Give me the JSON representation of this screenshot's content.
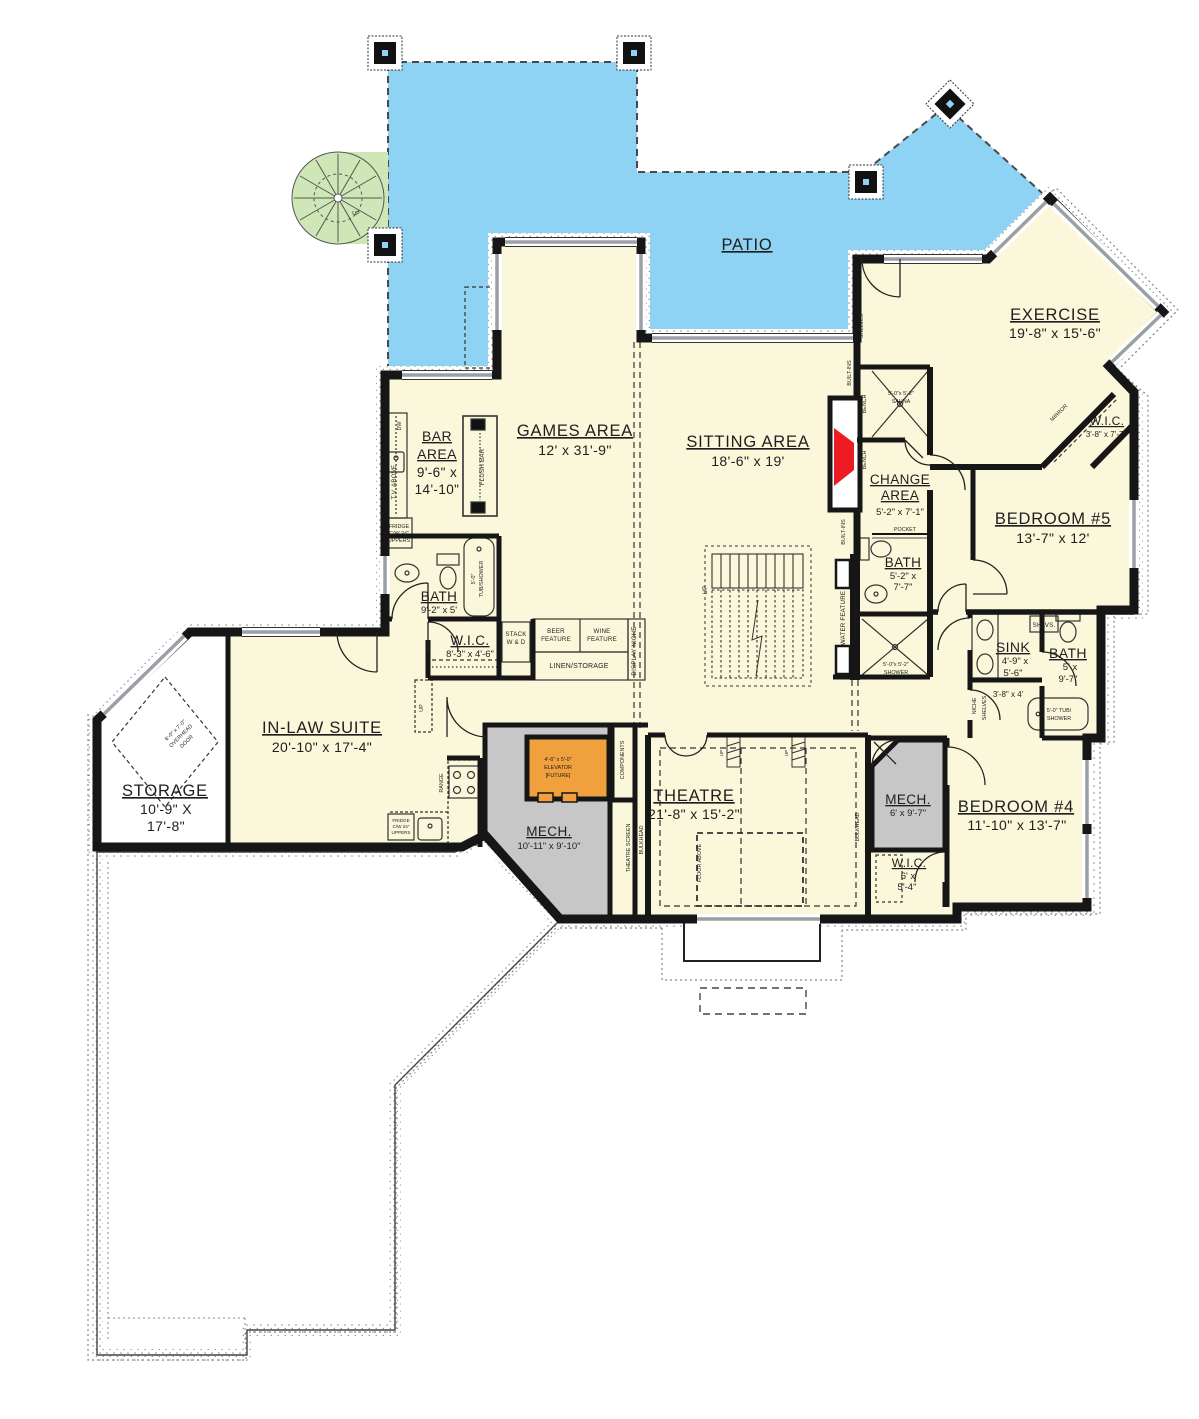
{
  "plan": {
    "colors": {
      "patio_blue": "#8ed2f4",
      "interior_yellow": "#fbf7da",
      "stair_green": "#cfe7b6",
      "mech_gray": "#c7c7c7",
      "elevator_orange": "#f0a03c",
      "fireplace_red": "#ed1c24",
      "wall_black": "#161616"
    },
    "labels": {
      "patio": "PATIO",
      "exercise": "EXERCISE",
      "exercise_d": "19'-8\" x 15'-6\"",
      "games": "GAMES AREA",
      "games_d": "12' x 31'-9\"",
      "sitting": "SITTING AREA",
      "sitting_d": "18'-6\" x 19'",
      "bar1": "BAR",
      "bar2": "AREA",
      "bar3": "9'-6\" x",
      "bar4": "14'-10\"",
      "bath_g": "BATH",
      "bath_g_d": "9'-2\" x 5'",
      "wic_g": "W.I.C.",
      "wic_g_d": "8'-3\" x 4'-6\"",
      "stack1": "STACK",
      "stack2": "W & D",
      "beer1": "BEER",
      "beer2": "FEATURE",
      "wine1": "WINE",
      "wine2": "FEATURE",
      "linen": "LINEN/STORAGE",
      "display_niche": "DISPLAY NICHE",
      "tub_g1": "5'-0\"",
      "tub_g2": "TUB/SHOWER",
      "tv_above": "T.V. ABOVE",
      "dw": "DW",
      "flush_bar": "FLUSH BAR",
      "fridge1": "FRIDGE",
      "fridge2": "C/W 24\"",
      "fridge3": "UPPERS",
      "sauna1": "5'-0\"x 5'-2\"",
      "sauna2": "SAUNA",
      "bench": "BENCH",
      "shelves": "SHELVES",
      "builtins": "BUILT-INS",
      "change1": "CHANGE",
      "change2": "AREA",
      "change_d": "5'-2\" x 7'-1\"",
      "pocket": "POCKET",
      "bath_c": "BATH",
      "bath_c_d1": "5'-2\" x",
      "bath_c_d2": "7'-7\"",
      "shower1": "5'-0\"x 5'-2\"",
      "shower2": "SHOWER",
      "water_feature": "WATER FEATURE",
      "up": "UP",
      "bed5": "BEDROOM #5",
      "bed5_d": "13'-7\" x 12'",
      "wic5": "W.I.C.",
      "wic5_d": "3'-8\" x 7'-7\"",
      "mirror": "MIRROR",
      "sink": "SINK",
      "sink_d1": "4'-9\" x",
      "sink_d2": "5'-6\"",
      "bath5": "BATH",
      "bath5_d1": "5' x",
      "bath5_d2": "9'-7\"",
      "shlvs": "SHLVS.",
      "niche": "NICHE",
      "closet_d": "3'-8\" x 4'",
      "tub451": "5'-0\" TUB/",
      "tub452": "SHOWER",
      "inlaw": "IN-LAW SUITE",
      "inlaw_d": "20'-10\" x 17'-4\"",
      "storage": "STORAGE",
      "storage_d1": "10'-9\" X",
      "storage_d2": "17'-8\"",
      "ohd1": "6'-0\" x 7'-0\"",
      "ohd2": "OVERHEAD",
      "ohd3": "DOOR",
      "range": "RANGE",
      "mech1": "MECH.",
      "mech1_d": "10'-11\" x 9'-10\"",
      "elev1": "4'-6\" x 5'-0\"",
      "elev2": "ELEVATOR",
      "elev3": "[FUTURE]",
      "components": "COMPONENTS",
      "tscreen": "THEATRE SCREEN",
      "bulkhead": "BULKHEAD",
      "theatre": "THEATRE",
      "theatre_d": "21'-8\" x 15'-2\"",
      "floor_above": "FLOOR ABOVE",
      "mech2": "MECH.",
      "mech2_d": "6' x 9'-7\"",
      "bed4": "BEDROOM #4",
      "bed4_d": "11'-10\" x 13'-7\"",
      "wic4": "W.I.C.",
      "wic4_d1": "6' x",
      "wic4_d2": "5'-4\""
    }
  }
}
